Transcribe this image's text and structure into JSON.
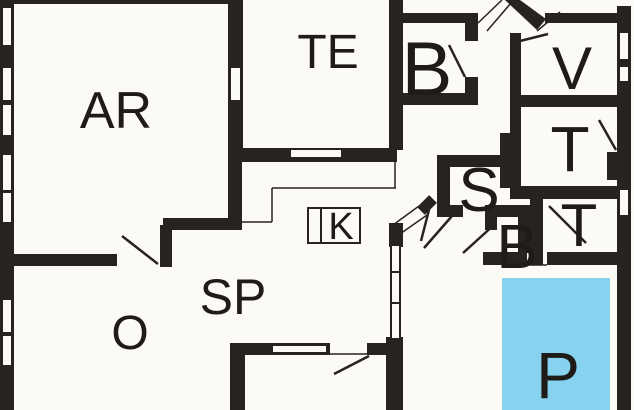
{
  "plan": {
    "title": "floor-plan",
    "background_color": "#fbfaf5",
    "wall_color": "#29231f",
    "label_color": "#1f1b18",
    "highlight_color": "#87d3ef",
    "rooms": [
      {
        "id": "ar",
        "label": "AR"
      },
      {
        "id": "te",
        "label": "TE"
      },
      {
        "id": "b-top",
        "label": "B"
      },
      {
        "id": "v",
        "label": "V"
      },
      {
        "id": "t-upper",
        "label": "T"
      },
      {
        "id": "s",
        "label": "S"
      },
      {
        "id": "b-small",
        "label": "B"
      },
      {
        "id": "t-lower",
        "label": "T"
      },
      {
        "id": "k",
        "label": "K"
      },
      {
        "id": "sp",
        "label": "SP"
      },
      {
        "id": "o",
        "label": "O"
      },
      {
        "id": "p",
        "label": "P",
        "highlighted": true
      }
    ]
  }
}
